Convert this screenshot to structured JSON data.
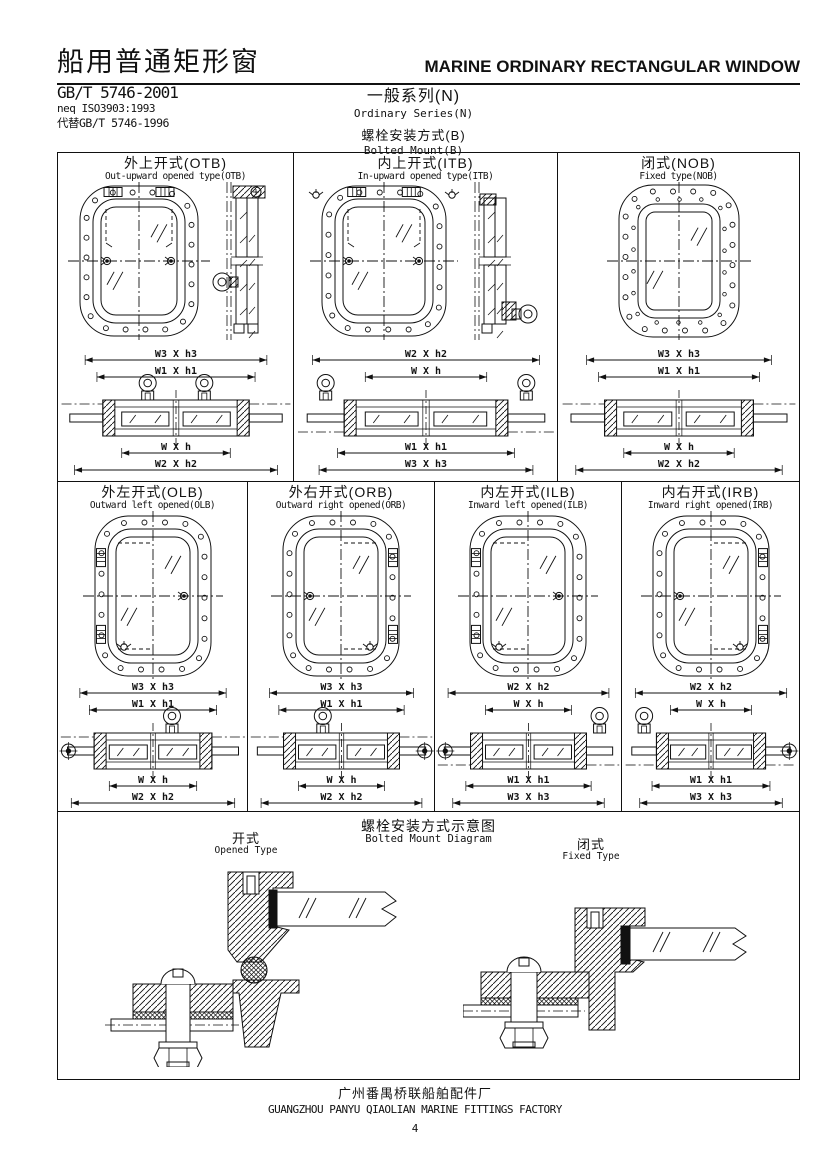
{
  "colors": {
    "ink": "#111111",
    "paper": "#ffffff"
  },
  "header": {
    "title_zh": "船用普通矩形窗",
    "title_en": "MARINE ORDINARY RECTANGULAR WINDOW",
    "standard": "GB/T 5746-2001",
    "equivalence": "neq ISO3903:1993",
    "replaces": "代替GB/T 5746-1996",
    "series_zh": "一般系列(N)",
    "series_en": "Ordinary Series(N)",
    "mount_zh": "螺栓安装方式(B)",
    "mount_en": "Bolted Mount(B)"
  },
  "cells": [
    {
      "id": "OTB",
      "title_zh": "外上开式(OTB)",
      "title_en": "Out-upward opened type(OTB)",
      "dims_top": [
        "W3 X h3",
        "W1 X h1"
      ],
      "dims_bottom": [
        "W X h",
        "W2 X h2"
      ]
    },
    {
      "id": "ITB",
      "title_zh": "内上开式(ITB)",
      "title_en": "In-upward opened type(ITB)",
      "dims_top": [
        "W2 X h2",
        "W X h"
      ],
      "dims_bottom": [
        "W1 X h1",
        "W3 X h3"
      ]
    },
    {
      "id": "NOB",
      "title_zh": "闭式(NOB)",
      "title_en": "Fixed type(NOB)",
      "dims_top": [
        "W3 X h3",
        "W1 X h1"
      ],
      "dims_bottom": [
        "W X h",
        "W2 X h2"
      ]
    },
    {
      "id": "OLB",
      "title_zh": "外左开式(OLB)",
      "title_en": "Outward left opened(OLB)",
      "dims_top": [
        "W3 X h3",
        "W1 X h1"
      ],
      "dims_bottom": [
        "W X h",
        "W2 X h2"
      ]
    },
    {
      "id": "ORB",
      "title_zh": "外右开式(ORB)",
      "title_en": "Outward right opened(ORB)",
      "dims_top": [
        "W3 X h3",
        "W1 X h1"
      ],
      "dims_bottom": [
        "W X h",
        "W2 X h2"
      ]
    },
    {
      "id": "ILB",
      "title_zh": "内左开式(ILB)",
      "title_en": "Inward left opened(ILB)",
      "dims_top": [
        "W2 X h2",
        "W X h"
      ],
      "dims_bottom": [
        "W1 X h1",
        "W3 X h3"
      ]
    },
    {
      "id": "IRB",
      "title_zh": "内右开式(IRB)",
      "title_en": "Inward right opened(IRB)",
      "dims_top": [
        "W2 X h2",
        "W X h"
      ],
      "dims_bottom": [
        "W1 X h1",
        "W3 X h3"
      ]
    }
  ],
  "mount_section": {
    "title_zh": "螺栓安装方式示意图",
    "title_en": "Bolted Mount Diagram",
    "opened_zh": "开式",
    "opened_en": "Opened Type",
    "fixed_zh": "闭式",
    "fixed_en": "Fixed Type"
  },
  "footer": {
    "factory_zh": "广州番禺桥联船舶配件厂",
    "factory_en": "GUANGZHOU PANYU QIAOLIAN MARINE FITTINGS FACTORY",
    "page": "4"
  }
}
